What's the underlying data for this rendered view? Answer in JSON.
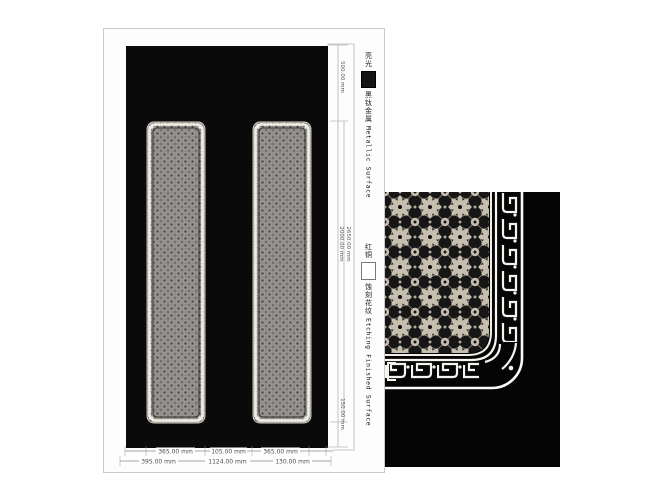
{
  "legend": {
    "metallic": {
      "prefix_cn": "亮光",
      "swatch": "black-filled-square",
      "name_cn": "黑钛金属",
      "name_en": "Metallic Surface"
    },
    "etching": {
      "head_cn": "红铜",
      "swatch": "white-outline-square",
      "name_cn": "蚀刻花纹",
      "name_en": "Etching Finished Surface"
    }
  },
  "dimensions": {
    "unit": "mm",
    "top_row": [
      "365.00 mm",
      "105.00 mm",
      "365.00 mm"
    ],
    "bottom_row": [
      "395.00 mm",
      "1124.00 mm",
      "130.00 mm"
    ],
    "right_column": [
      "500.00 mm",
      "2000.00 mm",
      "2650.00 mm",
      "150.00 mm"
    ]
  },
  "drawing": {
    "panel_count": 2
  },
  "colors": {
    "canvas_black": "#0a0a0a",
    "detail_black": "#050505",
    "ornament_light": "#c6bfb0",
    "panel_fill_gray": "#908e8a",
    "border_white": "#f4f3ef",
    "dim_line": "#8a8a8a",
    "sheet_border": "#c9c9c9"
  }
}
